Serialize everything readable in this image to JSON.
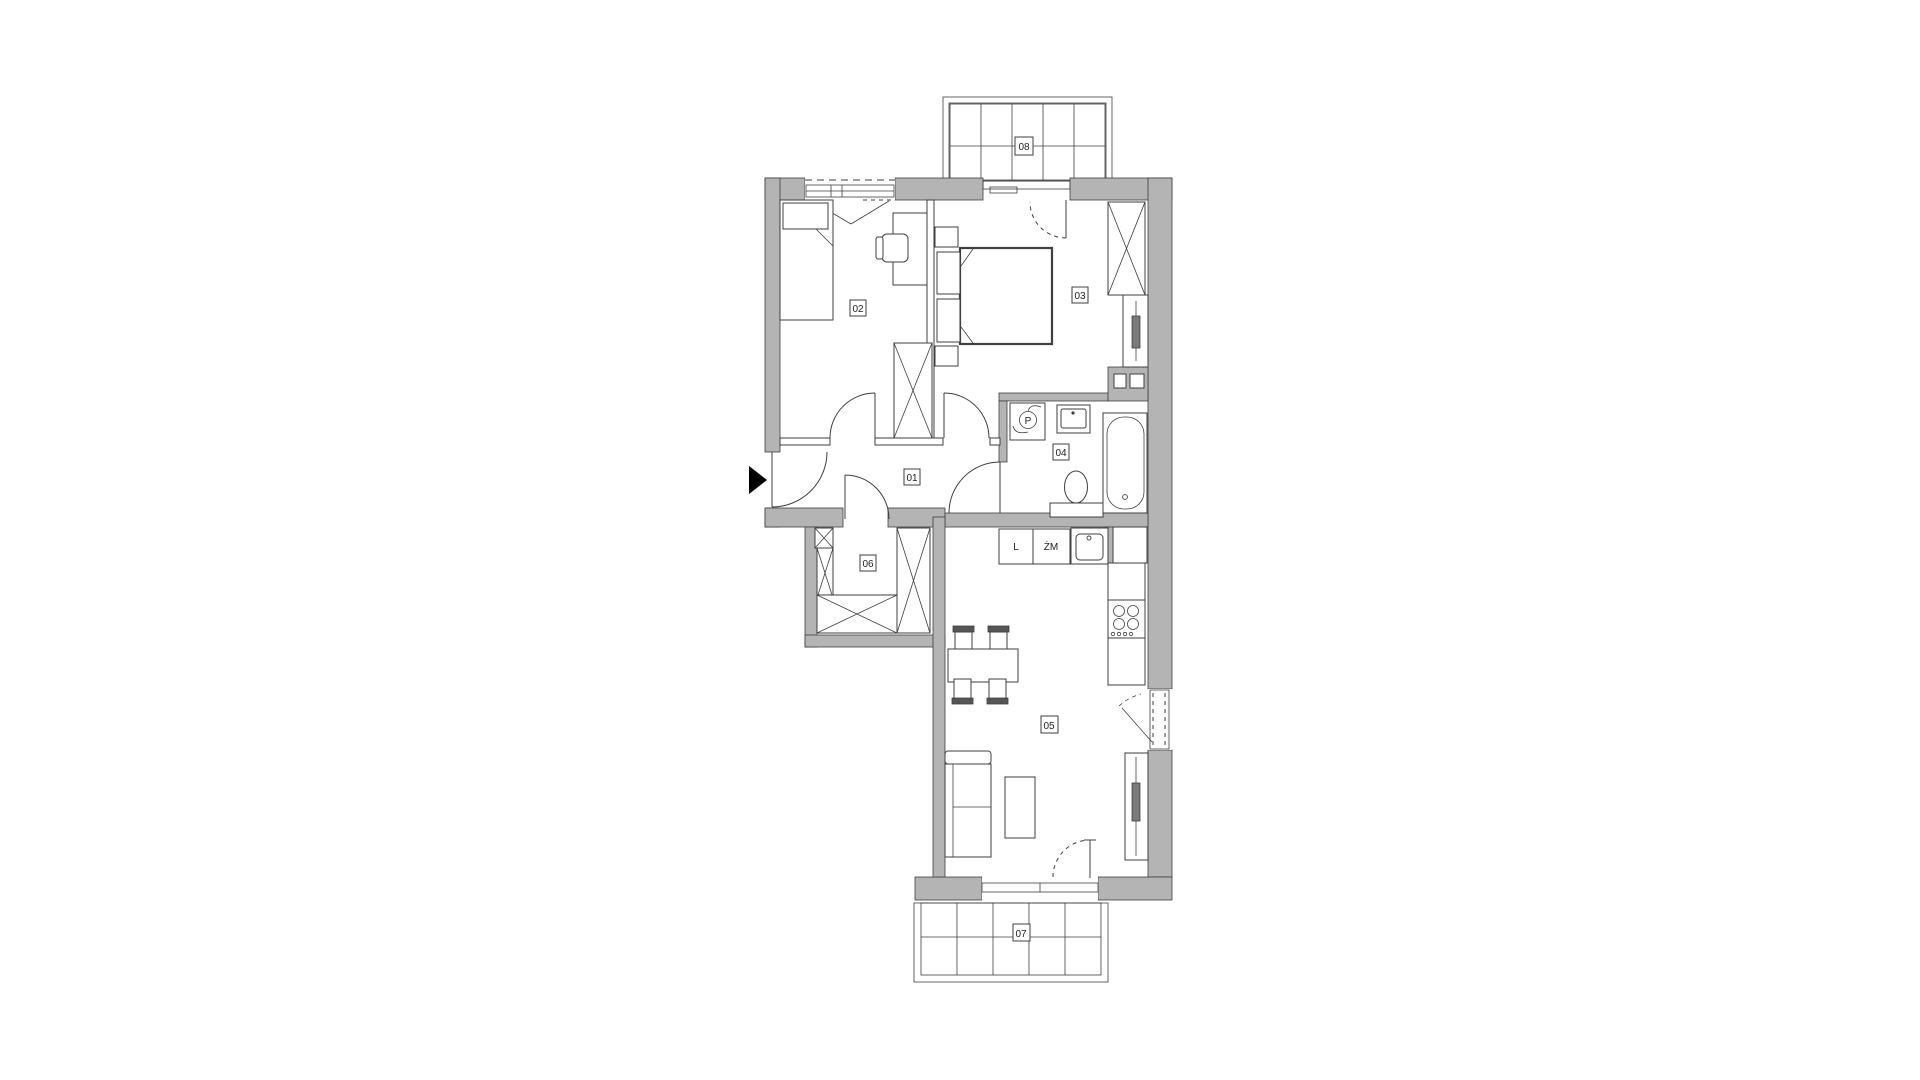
{
  "plan": {
    "colors": {
      "wall": "#b4b4b4",
      "line": "#3f3f3f",
      "background": "#ffffff"
    },
    "rooms": [
      {
        "label": "01"
      },
      {
        "label": "02"
      },
      {
        "label": "03"
      },
      {
        "label": "04"
      },
      {
        "label": "05"
      },
      {
        "label": "06"
      },
      {
        "label": "07"
      },
      {
        "label": "08"
      }
    ],
    "kitchen": {
      "fridge_label": "L",
      "dishwasher_label": "ŻM"
    },
    "bathroom": {
      "washer_symbol": "P"
    }
  }
}
